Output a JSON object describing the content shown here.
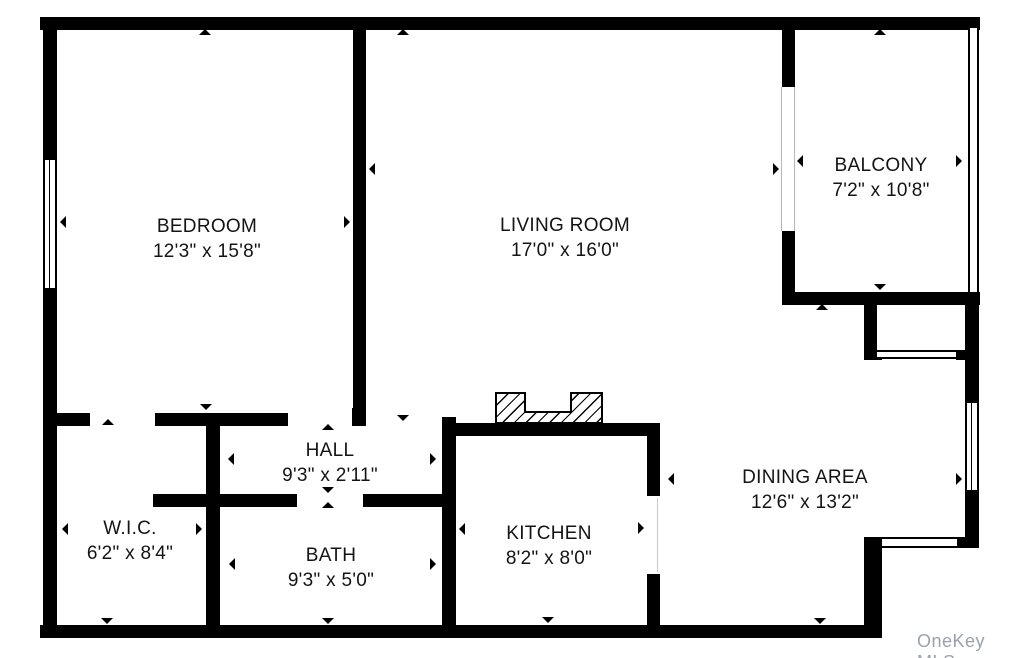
{
  "floorplan": {
    "rooms": [
      {
        "id": "bedroom",
        "name": "BEDROOM",
        "dimensions": "12'3\" x 15'8\""
      },
      {
        "id": "living-room",
        "name": "LIVING ROOM",
        "dimensions": "17'0\" x 16'0\""
      },
      {
        "id": "balcony",
        "name": "BALCONY",
        "dimensions": "7'2\" x 10'8\""
      },
      {
        "id": "hall",
        "name": "HALL",
        "dimensions": "9'3\" x 2'11\""
      },
      {
        "id": "wic",
        "name": "W.I.C.",
        "dimensions": "6'2\" x 8'4\""
      },
      {
        "id": "bath",
        "name": "BATH",
        "dimensions": "9'3\" x 5'0\""
      },
      {
        "id": "kitchen",
        "name": "KITCHEN",
        "dimensions": "8'2\" x 8'0\""
      },
      {
        "id": "dining-area",
        "name": "DINING AREA",
        "dimensions": "12'6\" x 13'2\""
      }
    ],
    "watermark": "OneKey MLS",
    "colors": {
      "wall": "#000000",
      "background": "#ffffff",
      "watermark": "#9aa2ac"
    }
  }
}
